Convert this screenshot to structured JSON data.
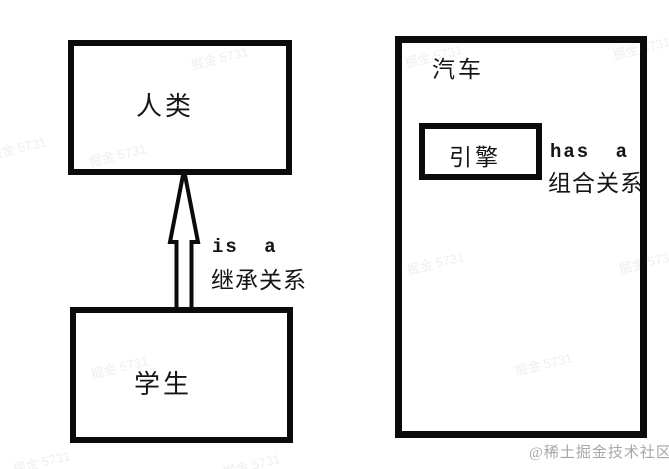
{
  "colors": {
    "background": "#ffffff",
    "line": "#0b0b0b",
    "text": "#151515",
    "credit_watermark": "#a9a6a6"
  },
  "inheritance": {
    "parent_class": "人类",
    "child_class": "学生",
    "relation_en": "is a",
    "relation_zh": "继承关系"
  },
  "composition": {
    "whole_class": "汽车",
    "part_class": "引擎",
    "relation_en": "has a",
    "relation_zh": "组合关系"
  },
  "watermarks": {
    "credit": "@稀土掘金技术社区",
    "tile": "掘金 5731"
  }
}
